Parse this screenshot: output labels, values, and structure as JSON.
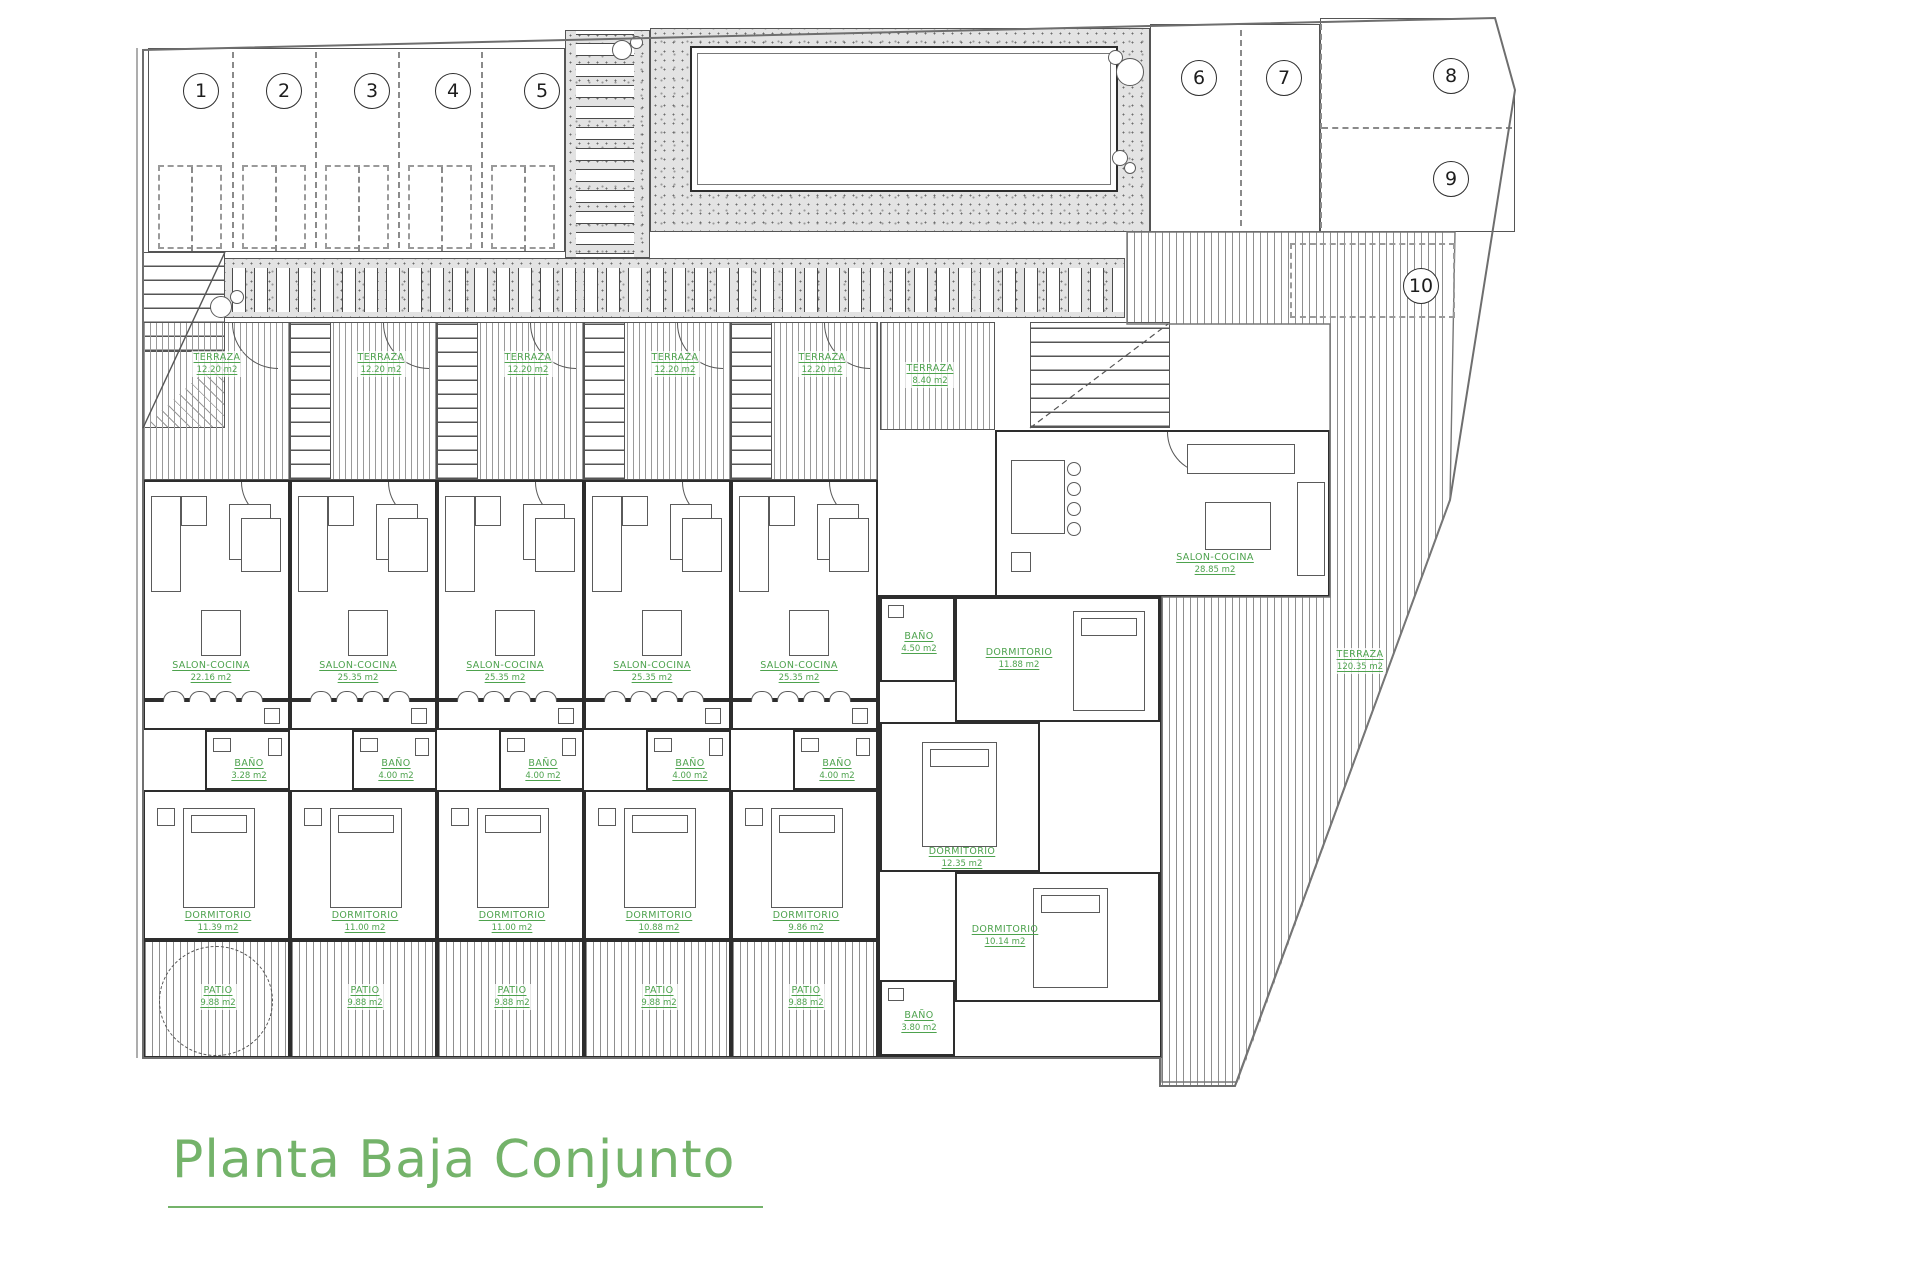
{
  "title": {
    "text": "Planta Baja Conjunto"
  },
  "plots": [
    "1",
    "2",
    "3",
    "4",
    "5",
    "6",
    "7",
    "8",
    "9",
    "10"
  ],
  "colors": {
    "label_green": "#4da24d",
    "title_green": "#74b36a",
    "wall": "#2d2d2d"
  },
  "units": [
    {
      "terraza": {
        "name": "TERRAZA",
        "area": "12.20 m2"
      },
      "salon": {
        "name": "SALON-COCINA",
        "area": "22.16 m2"
      },
      "bano": {
        "name": "BAÑO",
        "area": "3.28 m2"
      },
      "dorm": {
        "name": "DORMITORIO",
        "area": "11.39 m2"
      },
      "patio": {
        "name": "PATIO",
        "area": "9.88 m2"
      }
    },
    {
      "terraza": {
        "name": "TERRAZA",
        "area": "12.20 m2"
      },
      "salon": {
        "name": "SALON-COCINA",
        "area": "25.35 m2"
      },
      "bano": {
        "name": "BAÑO",
        "area": "4.00 m2"
      },
      "dorm": {
        "name": "DORMITORIO",
        "area": "11.00 m2"
      },
      "patio": {
        "name": "PATIO",
        "area": "9.88 m2"
      }
    },
    {
      "terraza": {
        "name": "TERRAZA",
        "area": "12.20 m2"
      },
      "salon": {
        "name": "SALON-COCINA",
        "area": "25.35 m2"
      },
      "bano": {
        "name": "BAÑO",
        "area": "4.00 m2"
      },
      "dorm": {
        "name": "DORMITORIO",
        "area": "11.00 m2"
      },
      "patio": {
        "name": "PATIO",
        "area": "9.88 m2"
      }
    },
    {
      "terraza": {
        "name": "TERRAZA",
        "area": "12.20 m2"
      },
      "salon": {
        "name": "SALON-COCINA",
        "area": "25.35 m2"
      },
      "bano": {
        "name": "BAÑO",
        "area": "4.00 m2"
      },
      "dorm": {
        "name": "DORMITORIO",
        "area": "10.88 m2"
      },
      "patio": {
        "name": "PATIO",
        "area": "9.88 m2"
      }
    },
    {
      "terraza": {
        "name": "TERRAZA",
        "area": "12.20 m2"
      },
      "salon": {
        "name": "SALON-COCINA",
        "area": "25.35 m2"
      },
      "bano": {
        "name": "BAÑO",
        "area": "4.00 m2"
      },
      "dorm": {
        "name": "DORMITORIO",
        "area": "9.86 m2"
      },
      "patio": {
        "name": "PATIO",
        "area": "9.88 m2"
      }
    }
  ],
  "big": {
    "terraza": {
      "name": "TERRAZA",
      "area": "8.40 m2"
    },
    "salon": {
      "name": "SALON-COCINA",
      "area": "28.85 m2"
    },
    "bano1": {
      "name": "BAÑO",
      "area": "4.50 m2"
    },
    "dorm1": {
      "name": "DORMITORIO",
      "area": "11.88 m2"
    },
    "dorm2": {
      "name": "DORMITORIO",
      "area": "12.35 m2"
    },
    "dorm3": {
      "name": "DORMITORIO",
      "area": "10.14 m2"
    },
    "bano2": {
      "name": "BAÑO",
      "area": "3.80 m2"
    },
    "garden": {
      "name": "TERRAZA",
      "area": "120.35 m2"
    }
  }
}
